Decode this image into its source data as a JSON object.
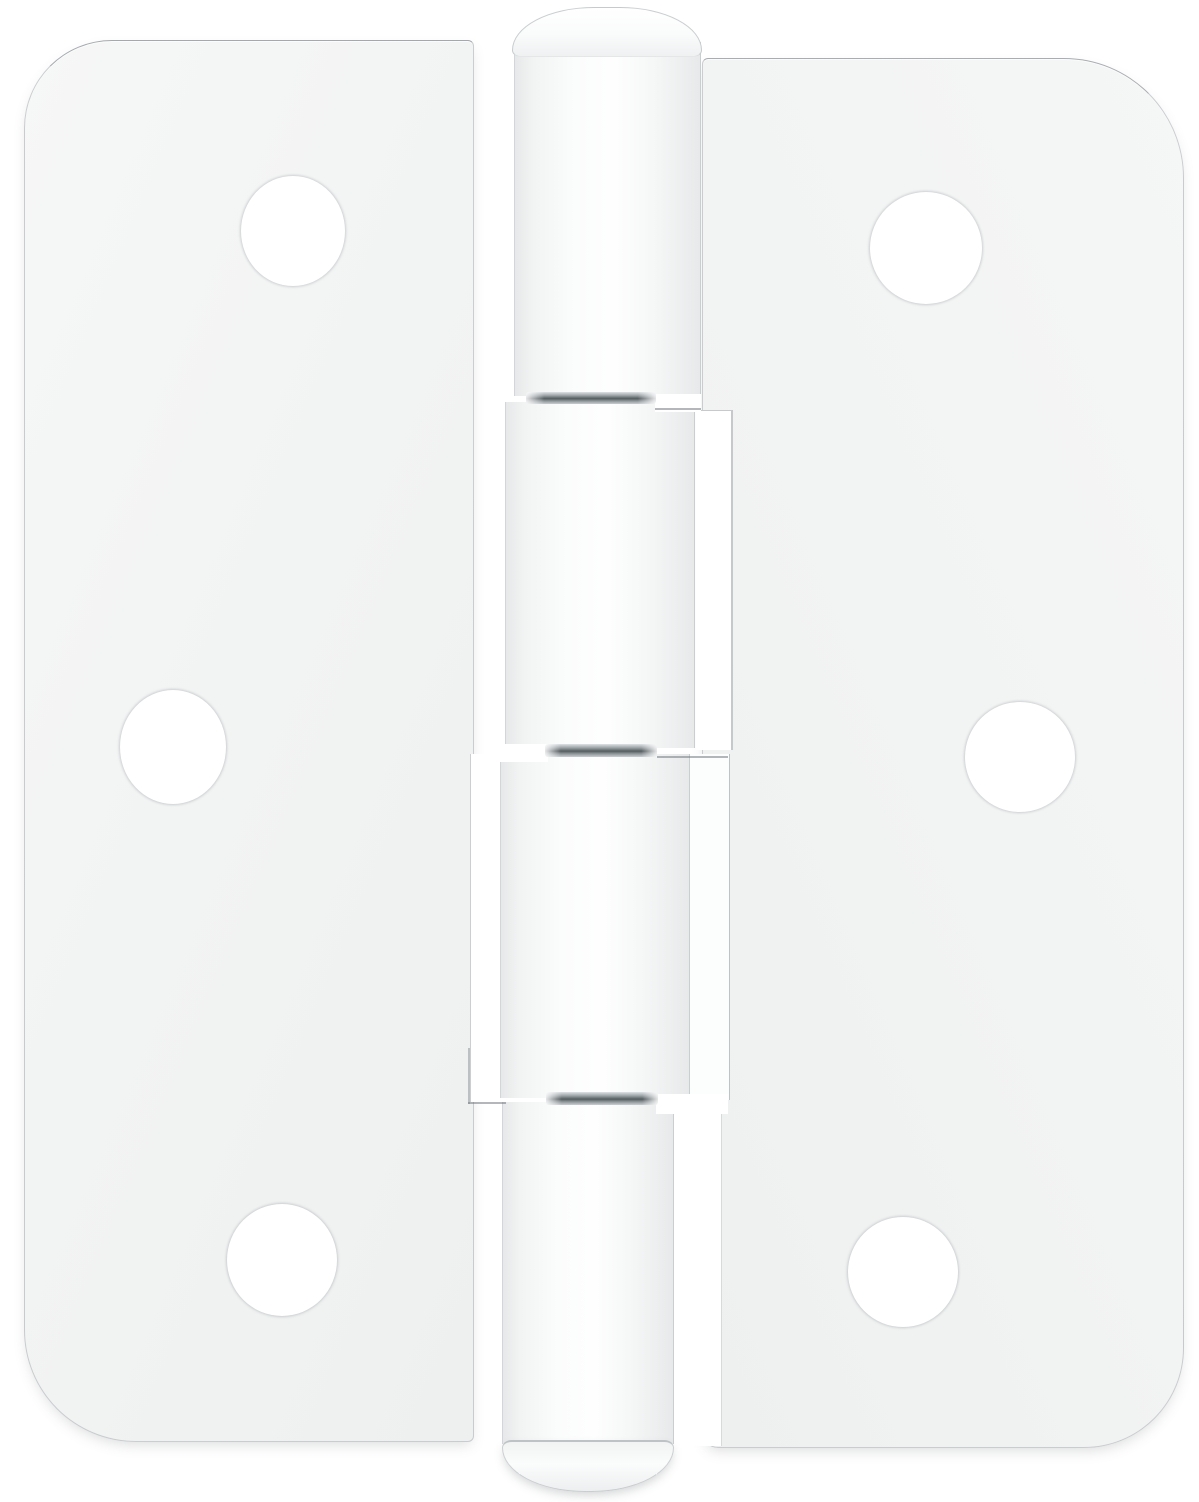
{
  "scene": {
    "type": "product-photo",
    "object": "white door hinge",
    "description": "White painted surface-mount door hinge with two leaves, a four-knuckle barrel with domed pin caps, and six round screw holes, photographed flat on a white background",
    "background_color": "#ffffff",
    "canvas": {
      "width": 1199,
      "height": 1502
    },
    "palette": {
      "leaf_white": "#f2f3f3",
      "highlight_white": "#ffffff",
      "edge_gray": "#b4babd",
      "knuckle_shade": "#e7e9ea",
      "pin_dark": "#555c60",
      "pin_mid": "#8f969a",
      "soft_shadow": "rgba(80,87,92,0.22)"
    },
    "counts": {
      "screw_holes": 6,
      "knuckles": 4,
      "pin_joints": 3,
      "leaves": 2
    },
    "parts": [
      {
        "name": "left-leaf",
        "kind": "leaf-left",
        "x": 24,
        "y": 40,
        "w": 450,
        "h": 1402,
        "r": "88px 6px 6px 112px"
      },
      {
        "name": "right-leaf",
        "kind": "leaf-right",
        "x": 702,
        "y": 58,
        "w": 482,
        "h": 1390,
        "r": "6px 120px 100px 16px"
      },
      {
        "name": "leaf-curl-highlight-right-upper",
        "kind": "strip strip-r2",
        "x": 696,
        "y": 410,
        "w": 37,
        "h": 340
      },
      {
        "name": "leaf-curl-highlight-right-lower",
        "kind": "strip strip-r3",
        "x": 690,
        "y": 754,
        "w": 40,
        "h": 346
      },
      {
        "name": "leaf-curl-highlight-left",
        "kind": "strip strip-l3",
        "x": 470,
        "y": 754,
        "w": 34,
        "h": 348
      },
      {
        "name": "leaf-cut-gap-right-bottom",
        "kind": "strip strip-r4",
        "x": 676,
        "y": 1102,
        "w": 46,
        "h": 344
      },
      {
        "name": "knuckle-1",
        "kind": "knuckle",
        "x": 514,
        "y": 42,
        "w": 187,
        "h": 354
      },
      {
        "name": "knuckle-2",
        "kind": "knuckle",
        "x": 505,
        "y": 402,
        "w": 190,
        "h": 346
      },
      {
        "name": "knuckle-3",
        "kind": "knuckle",
        "x": 500,
        "y": 754,
        "w": 190,
        "h": 344
      },
      {
        "name": "knuckle-4",
        "kind": "knuckle",
        "x": 502,
        "y": 1102,
        "w": 172,
        "h": 342
      },
      {
        "name": "pin-slot-top",
        "kind": "slot",
        "x": 655,
        "y": 394,
        "w": 46,
        "h": 18
      },
      {
        "name": "pin-slot-middle",
        "kind": "slot",
        "x": 499,
        "y": 744,
        "w": 49,
        "h": 18
      },
      {
        "name": "pin-slot-bottom",
        "kind": "slot",
        "x": 656,
        "y": 1094,
        "w": 72,
        "h": 20
      },
      {
        "name": "pin-joint-top",
        "kind": "pin",
        "x": 526,
        "y": 392,
        "w": 130,
        "h": 12
      },
      {
        "name": "pin-joint-middle",
        "kind": "pin",
        "x": 545,
        "y": 744,
        "w": 112,
        "h": 13
      },
      {
        "name": "pin-joint-bottom",
        "kind": "pin",
        "x": 546,
        "y": 1092,
        "w": 112,
        "h": 13
      },
      {
        "name": "pin-cap-top",
        "kind": "cap-top",
        "x": 512,
        "y": 7,
        "w": 190,
        "h": 50,
        "r": "95px 95px 10px 10px / 50px 50px 8px 8px"
      },
      {
        "name": "pin-cap-bottom",
        "kind": "cap-bottom",
        "x": 502,
        "y": 1440,
        "w": 172,
        "h": 52,
        "r": "10px 10px 86px 86px / 8px 8px 46px 46px"
      },
      {
        "name": "cut-line-right-upper",
        "kind": "hairline",
        "x": 655,
        "y": 408,
        "w": 46,
        "h": 2
      },
      {
        "name": "cut-line-right-middle",
        "kind": "hairline",
        "x": 657,
        "y": 756,
        "w": 71,
        "h": 2
      },
      {
        "name": "cut-line-left-horizontal",
        "kind": "hairline",
        "x": 468,
        "y": 1102,
        "w": 38,
        "h": 2
      },
      {
        "name": "cut-line-left-vertical",
        "kind": "vline",
        "x": 468,
        "y": 1048,
        "w": 2,
        "h": 56
      },
      {
        "name": "screw-hole-left-top",
        "kind": "hole",
        "x": 241,
        "y": 176,
        "w": 104,
        "h": 110,
        "r": "50%"
      },
      {
        "name": "screw-hole-right-top",
        "kind": "hole",
        "x": 870,
        "y": 192,
        "w": 112,
        "h": 112,
        "r": "50%"
      },
      {
        "name": "screw-hole-left-middle",
        "kind": "hole",
        "x": 120,
        "y": 690,
        "w": 106,
        "h": 114,
        "r": "50%"
      },
      {
        "name": "screw-hole-right-middle",
        "kind": "hole",
        "x": 965,
        "y": 702,
        "w": 110,
        "h": 110,
        "r": "50%"
      },
      {
        "name": "screw-hole-left-bottom",
        "kind": "hole",
        "x": 227,
        "y": 1204,
        "w": 110,
        "h": 112,
        "r": "50%"
      },
      {
        "name": "screw-hole-right-bottom",
        "kind": "hole",
        "x": 848,
        "y": 1217,
        "w": 110,
        "h": 110,
        "r": "50%"
      }
    ]
  }
}
